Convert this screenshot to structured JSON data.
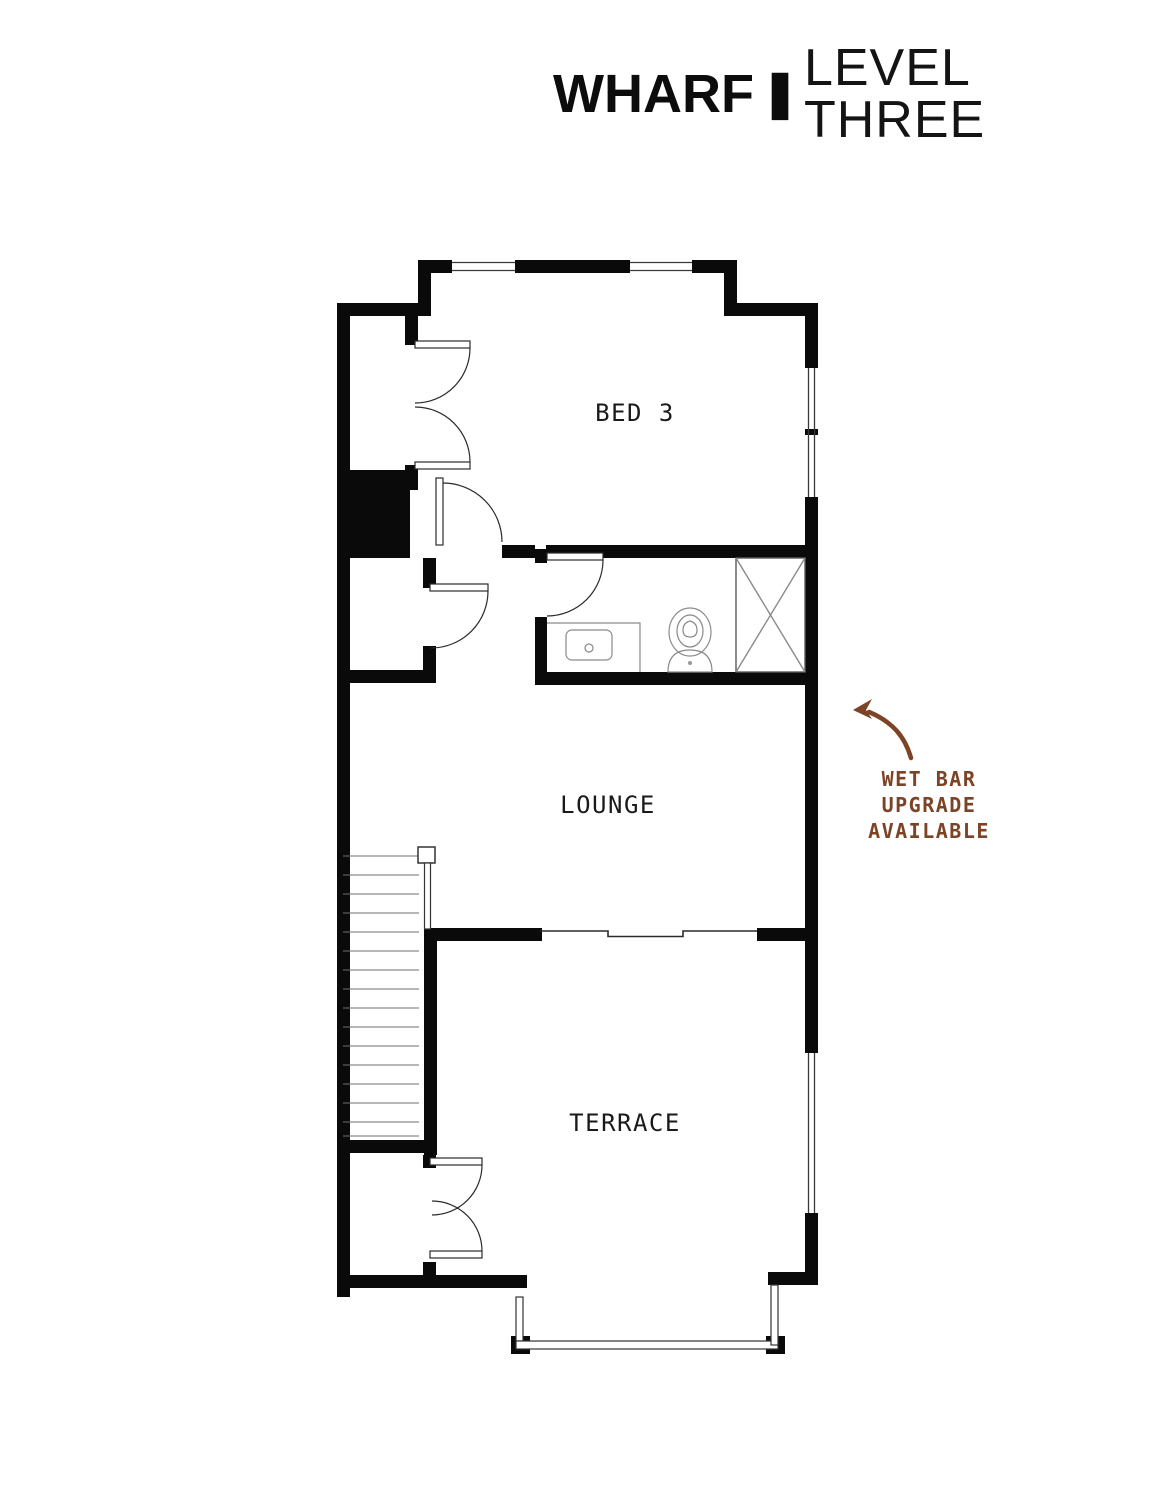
{
  "title": {
    "brand": "WHARF",
    "separator": "|",
    "page": "LEVEL THREE"
  },
  "floorplan": {
    "rooms": {
      "bed3": {
        "label": "BED 3"
      },
      "lounge": {
        "label": "LOUNGE"
      },
      "terrace": {
        "label": "TERRACE"
      }
    }
  },
  "annotation": {
    "lines": [
      "WET BAR",
      "UPGRADE",
      "AVAILABLE"
    ],
    "color": "#7d4327"
  },
  "colors": {
    "background": "#ffffff",
    "walls": "#0a0a0a",
    "thin_lines": "#3a3a3a",
    "fixture_lines": "#8a8a8a",
    "label_text": "#1a1a1a"
  }
}
